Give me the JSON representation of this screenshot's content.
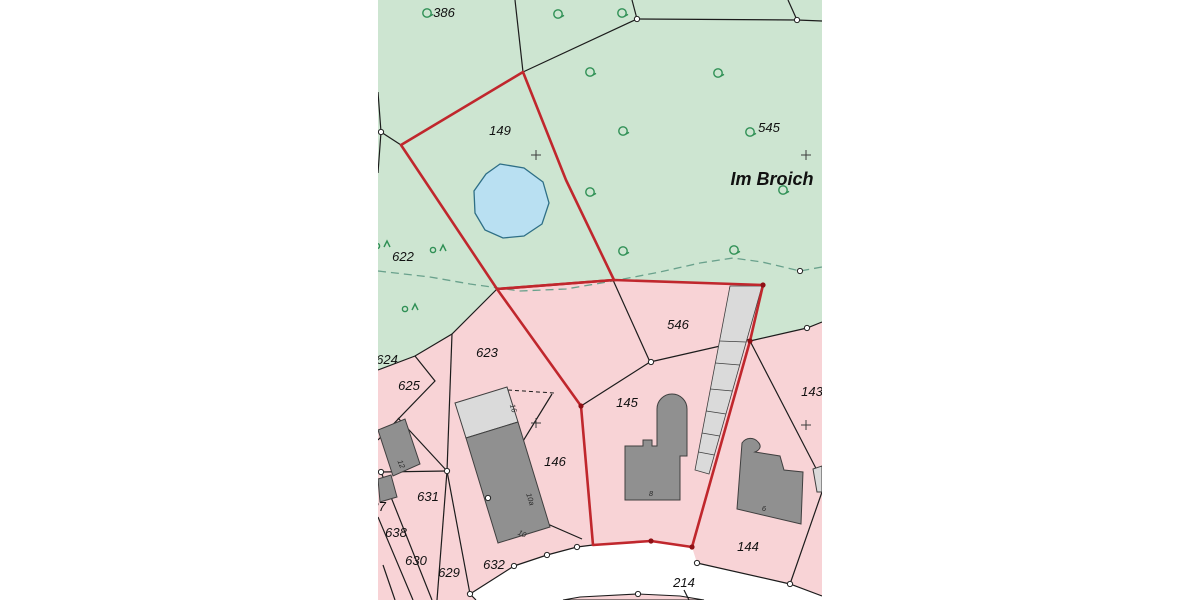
{
  "map": {
    "area_name": "Im Broich",
    "colors": {
      "green_area": "#cde5d1",
      "pink_area": "#f8d3d6",
      "road": "#ffffff",
      "pond_fill": "#b9e0f2",
      "pond_stroke": "#2e6f86",
      "red_boundary": "#c0272d",
      "red_point": "#8f1015",
      "building_dark": "#909090",
      "building_light": "#dadada",
      "building_stroke": "#3f3f3f",
      "line": "#1c1c1c",
      "dashed_vegetation": "#69a18c",
      "tree": "#2f9055",
      "label": "#111111",
      "house_number": "#2b2b2b"
    },
    "parcel_labels": [
      {
        "text": "386",
        "x": 444,
        "y": 17
      },
      {
        "text": "545",
        "x": 769,
        "y": 132
      },
      {
        "text": "149",
        "x": 500,
        "y": 135
      },
      {
        "text": "622",
        "x": 403,
        "y": 261
      },
      {
        "text": "623",
        "x": 487,
        "y": 357
      },
      {
        "text": "624",
        "x": 387,
        "y": 364
      },
      {
        "text": "625",
        "x": 409,
        "y": 390
      },
      {
        "text": "546",
        "x": 678,
        "y": 329
      },
      {
        "text": "145",
        "x": 627,
        "y": 407
      },
      {
        "text": "146",
        "x": 555,
        "y": 466
      },
      {
        "text": "143",
        "x": 812,
        "y": 396
      },
      {
        "text": "631",
        "x": 428,
        "y": 501
      },
      {
        "text": "637",
        "x": 375,
        "y": 511
      },
      {
        "text": "638",
        "x": 396,
        "y": 537
      },
      {
        "text": "630",
        "x": 416,
        "y": 565
      },
      {
        "text": "629",
        "x": 449,
        "y": 577
      },
      {
        "text": "632",
        "x": 494,
        "y": 569
      },
      {
        "text": "144",
        "x": 748,
        "y": 551
      },
      {
        "text": "214",
        "x": 684,
        "y": 587
      }
    ],
    "house_numbers": [
      {
        "text": "16",
        "x": 511,
        "y": 409,
        "rot": 72
      },
      {
        "text": "10a",
        "x": 528,
        "y": 500,
        "rot": 72
      },
      {
        "text": "10",
        "x": 521,
        "y": 536,
        "rot": 25
      },
      {
        "text": "8",
        "x": 651,
        "y": 496,
        "rot": 0
      },
      {
        "text": "6",
        "x": 764,
        "y": 511,
        "rot": 0
      },
      {
        "text": "12",
        "x": 399,
        "y": 465,
        "rot": 68
      }
    ],
    "symbols": {
      "deciduous_tree_icon_positions": [
        [
          427,
          13
        ],
        [
          558,
          14
        ],
        [
          622,
          13
        ],
        [
          590,
          72
        ],
        [
          718,
          73
        ],
        [
          623,
          131
        ],
        [
          750,
          132
        ],
        [
          590,
          192
        ],
        [
          783,
          190
        ],
        [
          623,
          251
        ],
        [
          734,
          250
        ]
      ],
      "mixed_tree_icon_positions": [
        [
          382,
          244
        ],
        [
          438,
          248
        ],
        [
          410,
          307
        ]
      ],
      "plus_mark_icon_positions": [
        [
          536,
          155
        ],
        [
          806,
          155
        ],
        [
          536,
          423
        ],
        [
          806,
          425
        ]
      ],
      "boundary_point_positions": [
        [
          637,
          19
        ],
        [
          797,
          20
        ],
        [
          381,
          132
        ],
        [
          800,
          271
        ],
        [
          807,
          328
        ],
        [
          651,
          362
        ],
        [
          447,
          471
        ],
        [
          488,
          498
        ],
        [
          381,
          472
        ],
        [
          514,
          566
        ],
        [
          547,
          555
        ],
        [
          577,
          547
        ],
        [
          697,
          563
        ],
        [
          790,
          584
        ],
        [
          638,
          594
        ],
        [
          470,
          594
        ]
      ],
      "red_point_positions": [
        [
          581,
          406
        ],
        [
          651,
          541
        ],
        [
          692,
          547
        ],
        [
          750,
          341
        ],
        [
          763,
          285
        ]
      ]
    }
  }
}
